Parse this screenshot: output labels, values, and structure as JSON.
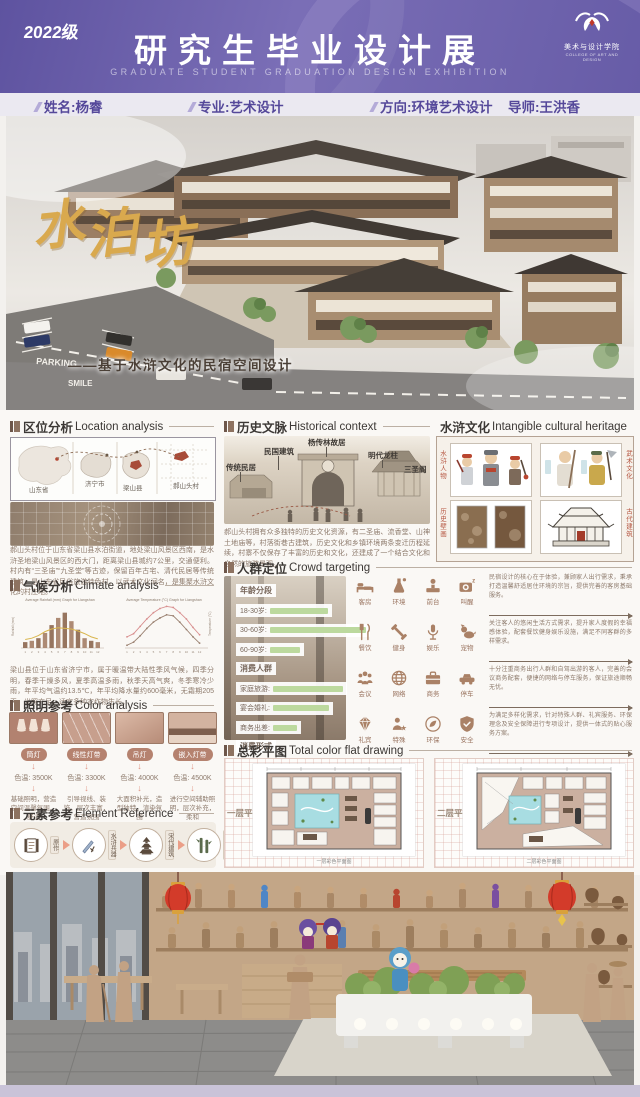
{
  "header": {
    "badge": "2022级",
    "title": "研究生毕业设计展",
    "subtitle": "GRADUATE STUDENT GRADUATION DESIGN EXHIBITION",
    "logo": {
      "text": "美术与设计学院",
      "subtext": "COLLEGE OF ART AND DESIGN"
    }
  },
  "info_bar": {
    "name": "姓名:杨睿",
    "major": "专业:艺术设计",
    "direction": "方向:环境艺术设计",
    "advisor": "导师:王洪香"
  },
  "hero": {
    "title_chars": [
      "水",
      "泊",
      "坊"
    ],
    "subtitle": "——基于水浒文化的民宿空间设计",
    "road_text_parking": "PARKING",
    "road_text_smile": "SMILE"
  },
  "sections": {
    "location": {
      "title_zh": "区位分析",
      "title_en": "Location analysis",
      "map_labels": [
        "山东省",
        "济宁市",
        "梁山县",
        "郝山头村"
      ],
      "paragraph": "郝山头村位于山东省梁山县水泊街道，地处梁山风景区西南，是水浒圣地梁山风景区的西大门，距离梁山县城约7公里，交通便利。村内有“三圣庙”“九圣堂”等古迹，保留百年古宅、清代民居等传统建筑，是山东省民俗旅游特色村，以武术文化闻名，是集聚水浒文化的村庄地。"
    },
    "climate": {
      "title_zh": "气候分析",
      "title_en": "Climate analysis",
      "paragraph": "梁山县位于山东省济宁市，属于暖温带大陆性季风气候，四季分明，春季干燥多风，夏季高温多雨，秋季天高气爽，冬季寒冷少雨，年平均气温约13.5℃，年平均降水量约600毫米，无霜期205天，光照充足，适宜多种农作物生长。",
      "chart_data": [
        {
          "type": "bar",
          "title": "Average Rainfall (mm) Graph for Liangshan",
          "categories": [
            "1",
            "2",
            "3",
            "4",
            "5",
            "6",
            "7",
            "8",
            "9",
            "10",
            "11",
            "12"
          ],
          "values": [
            18,
            22,
            30,
            46,
            70,
            92,
            108,
            82,
            56,
            30,
            22,
            18
          ],
          "line_overlay": [
            26,
            30,
            38,
            50,
            58,
            62,
            60,
            58,
            52,
            44,
            34,
            28
          ],
          "ylabel": "Rainfall (mm)",
          "ylim": [
            0,
            110
          ]
        },
        {
          "type": "line",
          "title": "Average Temperature (°C) Graph for Liangshan",
          "x": [
            "1",
            "2",
            "3",
            "4",
            "5",
            "6",
            "7",
            "8",
            "9",
            "10",
            "11",
            "12"
          ],
          "series": [
            {
              "name": "High",
              "values": [
                3,
                6,
                13,
                20,
                26,
                30,
                32,
                31,
                26,
                20,
                12,
                5
              ]
            },
            {
              "name": "Low",
              "values": [
                -5,
                -2,
                4,
                11,
                17,
                21,
                24,
                23,
                17,
                10,
                3,
                -3
              ]
            }
          ],
          "ylabel": "Temperature (°C)"
        }
      ]
    },
    "lighting": {
      "title_zh": "照明参考",
      "title_en": "Color analysis",
      "items": [
        {
          "label": "筒灯",
          "temp": "色温: 3500K",
          "desc": "基础照明，营造空间温馨氛围、舒适"
        },
        {
          "label": "线性灯带",
          "temp": "色温: 3300K",
          "desc": "引导视线、装饰，层次丰富，营造氛围"
        },
        {
          "label": "吊灯",
          "temp": "色温: 4000K",
          "desc": "大面积补光，造型独特，渲染氛围"
        },
        {
          "label": "嵌入灯带",
          "temp": "色温: 4500K",
          "desc": "进行空间辅助照明，层次补充，柔和"
        }
      ]
    },
    "elements": {
      "title_zh": "元素参考",
      "title_en": "Element Reference",
      "steps": [
        {
          "icon": "scroll-icon",
          "label": "原作"
        },
        {
          "icon": "sword-icon",
          "label": "水浒兵器"
        },
        {
          "icon": "pagoda-icon",
          "label": "宋代建筑"
        },
        {
          "icon": "bamboo-icon",
          "label": "植物元素"
        }
      ]
    },
    "history": {
      "title_zh": "历史文脉",
      "title_en": "Historical context",
      "labels": [
        "传统民居",
        "民国建筑",
        "杨传林故居",
        "明代龙柱",
        "三圣阁"
      ],
      "paragraph": "郝山头村拥有众多独特的历史文化资源，有二圣庙、流香堂、山神土地庙等，村落街巷古建筑，历史文化和乡镇环境两条变迁历程延续，村寨不仅保存了丰富的历史和文化，还建成了一个结合文化和自然的旅游景观。"
    },
    "heritage": {
      "title_zh": "水浒文化",
      "title_en": "Intangible cultural heritage",
      "side_labels": [
        "水浒人物",
        "武术文化",
        "历史壁画",
        "古代建筑"
      ]
    },
    "crowd": {
      "title_zh": "人群定位",
      "title_en": "Crowd targeting",
      "chart_data": {
        "type": "bar",
        "groups": [
          {
            "title": "年龄分段",
            "rows": [
              {
                "label": "18-30岁:",
                "value": 58
              },
              {
                "label": "30-60岁:",
                "value": 96
              },
              {
                "label": "60-90岁:",
                "value": 30
              }
            ]
          },
          {
            "title": "消费人群",
            "rows": [
              {
                "label": "家庭旅游:",
                "value": 70
              },
              {
                "label": "宴会婚礼:",
                "value": 56
              },
              {
                "label": "商务出差:",
                "value": 24
              }
            ]
          },
          {
            "title": "消费形式",
            "rows": [
              {
                "label": "住宿消费:",
                "value": 64
              },
              {
                "label": "中端消费:",
                "value": 34
              },
              {
                "label": "点餐消费:",
                "value": 16
              }
            ]
          }
        ]
      },
      "services": [
        {
          "icons": [
            {
              "name": "bed-icon",
              "label": "客房"
            },
            {
              "name": "environment-icon",
              "label": "环境"
            },
            {
              "name": "reception-icon",
              "label": "前台"
            },
            {
              "name": "wakeup-icon",
              "label": "叫醒"
            }
          ],
          "text": "民宿设计的核心在于体验，兼顾家人出行需求，秉承打造温馨舒适居住环境的宗旨，提供完善的客房基础服务。"
        },
        {
          "icons": [
            {
              "name": "dining-icon",
              "label": "餐饮"
            },
            {
              "name": "fitness-icon",
              "label": "健身"
            },
            {
              "name": "entertainment-icon",
              "label": "娱乐"
            },
            {
              "name": "pet-icon",
              "label": "宠物"
            }
          ],
          "text": "关注客人的悠闲生活方式需求，提升家人度假的幸福感体验，配套餐饮健身娱乐设施，满足不同客群的多样需求。"
        },
        {
          "icons": [
            {
              "name": "meeting-icon",
              "label": "会议"
            },
            {
              "name": "network-icon",
              "label": "网络"
            },
            {
              "name": "business-icon",
              "label": "商务"
            },
            {
              "name": "parking-icon",
              "label": "停车"
            }
          ],
          "text": "十分注重商务出行人群和自驾出游的客人，完善的会议商务配套，便捷的网络与停车服务，保证旅途顺畅无忧。"
        },
        {
          "icons": [
            {
              "name": "gift-icon",
              "label": "礼宾"
            },
            {
              "name": "special-icon",
              "label": "特殊"
            },
            {
              "name": "eco-icon",
              "label": "环保"
            },
            {
              "name": "safety-icon",
              "label": "安全"
            }
          ],
          "text": "为满足多样化需求，针对特殊人群、礼宾服务、环保理念及安全保障进行专项设计，提供一体式的贴心服务方案。"
        }
      ]
    },
    "floorplan": {
      "title_zh": "总彩平图",
      "title_en": "Total color flat drawing",
      "plans": [
        {
          "label": "一层平面",
          "caption": "一层彩色平面图"
        },
        {
          "label": "二层平面",
          "caption": "二层彩色平面图"
        }
      ]
    }
  },
  "colors": {
    "header_purple": "#675ca7",
    "info_purple": "#55489a",
    "gold_title": "#d9a94e",
    "body_brown": "#8d7a6c",
    "bar_green": "#bcd99e",
    "icon_brown": "#aa8166",
    "red_label": "#b5543f"
  }
}
